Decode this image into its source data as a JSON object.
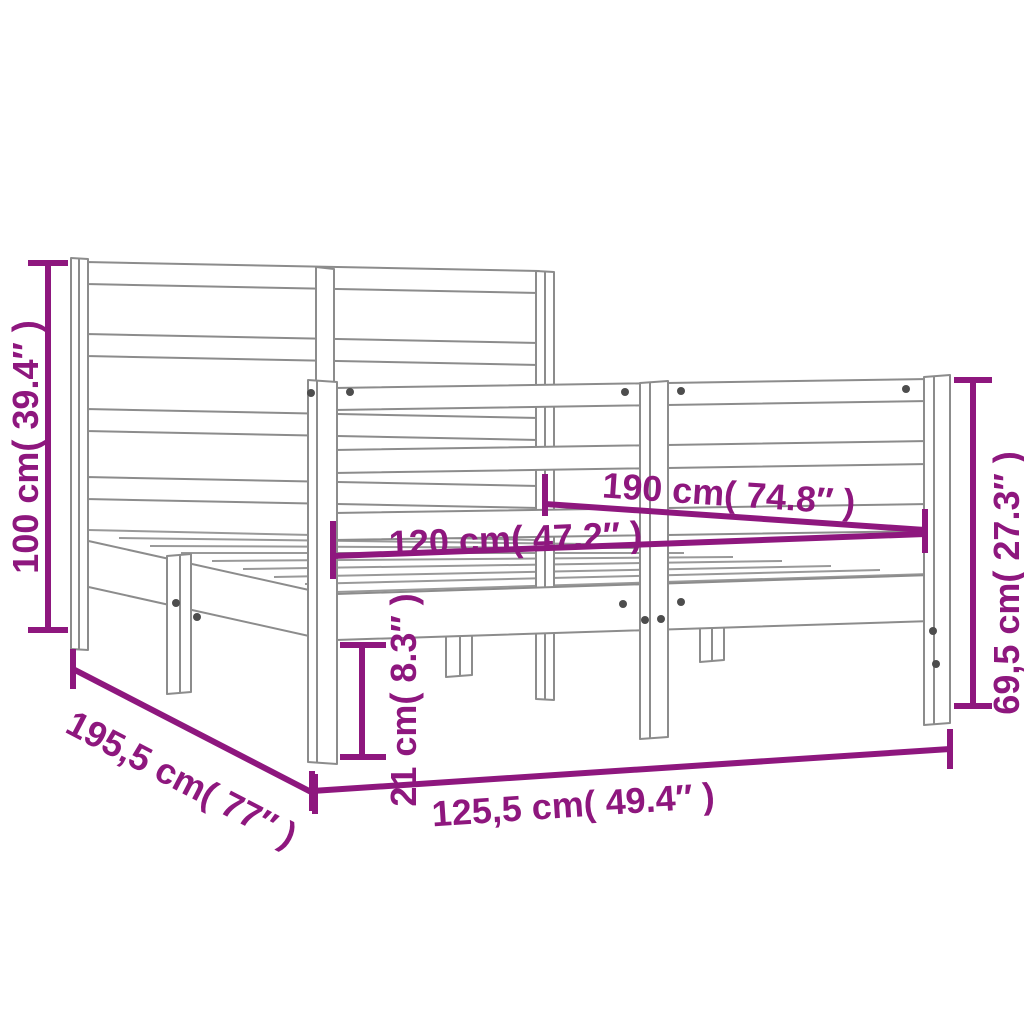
{
  "diagram": {
    "type": "product-dimension-drawing",
    "subject": "bed-frame-with-headboard",
    "colors": {
      "accent": "#8E177E",
      "outline": "#8C8C8C",
      "screw": "#4D4D4D",
      "background": "#FFFFFF"
    },
    "dimensions": {
      "headboard_height": {
        "label": "100 cm( 39.4″ )",
        "cm": "100",
        "inches": "39.4"
      },
      "footboard_height": {
        "label": "69,5 cm( 27.3″ )",
        "cm": "69,5",
        "inches": "27.3"
      },
      "mattress_length": {
        "label": "190 cm( 74.8″ )",
        "cm": "190",
        "inches": "74.8"
      },
      "mattress_width": {
        "label": "120 cm( 47.2″ )",
        "cm": "120",
        "inches": "47.2"
      },
      "base_height": {
        "label": "21 cm( 8.3″ )",
        "cm": "21",
        "inches": "8.3"
      },
      "frame_length": {
        "label": "195,5 cm( 77″ )",
        "cm": "195,5",
        "inches": "77"
      },
      "frame_width": {
        "label": "125,5 cm( 49.4″ )",
        "cm": "125,5",
        "inches": "49.4"
      }
    }
  }
}
